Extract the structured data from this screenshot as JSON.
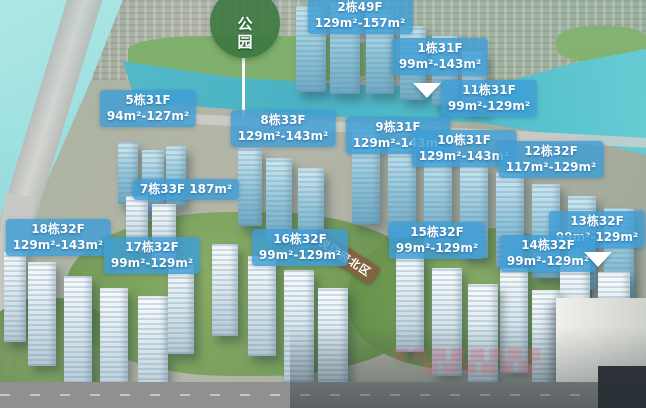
{
  "park_marker": {
    "label": "公园"
  },
  "project_marker": {
    "label": "悦江府北区"
  },
  "labels": [
    {
      "id": "b2",
      "line1": "2栋49F",
      "line2": "129m²-157m²"
    },
    {
      "id": "b1",
      "line1": "1栋31F",
      "line2": "99m²-143m²"
    },
    {
      "id": "b11",
      "line1": "11栋31F",
      "line2": "99m²-129m²",
      "pointer": "left"
    },
    {
      "id": "b5",
      "line1": "5栋31F",
      "line2": "94m²-127m²"
    },
    {
      "id": "b8",
      "line1": "8栋33F",
      "line2": "129m²-143m²"
    },
    {
      "id": "b9",
      "line1": "9栋31F",
      "line2": "129m²-143m²"
    },
    {
      "id": "b10",
      "line1": "10栋31F",
      "line2": "129m²-143m²"
    },
    {
      "id": "b12",
      "line1": "12栋32F",
      "line2": "117m²-129m²"
    },
    {
      "id": "b7",
      "line1": "7栋33F 187m²",
      "line2": ""
    },
    {
      "id": "b13",
      "line1": "13栋32F",
      "line2": "99m²-129m²",
      "pointer": "below"
    },
    {
      "id": "b18",
      "line1": "18栋32F",
      "line2": "129m²-143m²"
    },
    {
      "id": "b17",
      "line1": "17栋32F",
      "line2": "99m²-129m²"
    },
    {
      "id": "b16",
      "line1": "16栋32F",
      "line2": "99m²-129m²"
    },
    {
      "id": "b15",
      "line1": "15栋32F",
      "line2": "99m²-129m²"
    },
    {
      "id": "b14",
      "line1": "14栋32F",
      "line2": "99m²-129m²"
    }
  ],
  "colors": {
    "label_bg": "#3e9dd6",
    "label_text": "#ffffff",
    "park_bg": "#3a763e",
    "project_bg": "#825f3e",
    "water": "#7fd2d8"
  }
}
